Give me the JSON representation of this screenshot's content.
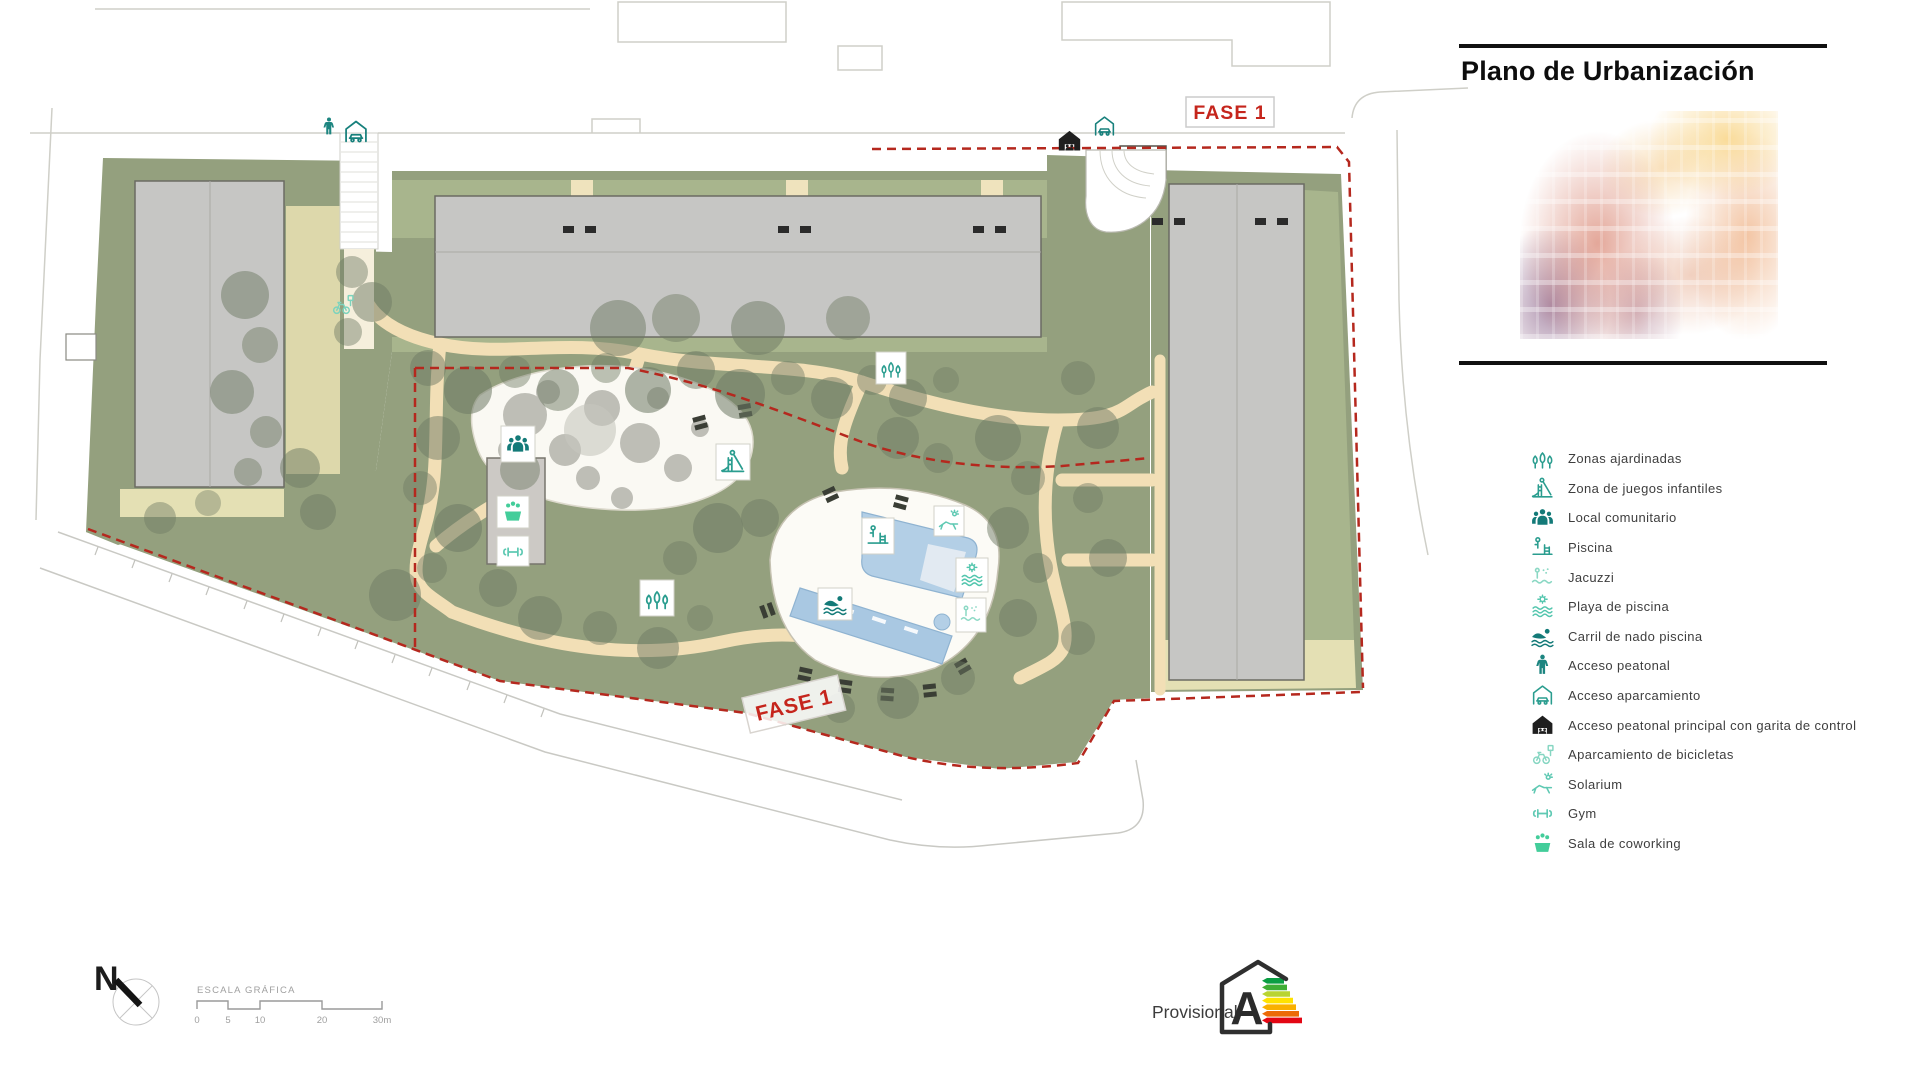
{
  "header": {
    "title": "Plano de Urbanización"
  },
  "plan": {
    "fase_label_top": "FASE 1",
    "fase_label_bottom": "FASE 1",
    "north_label": "N"
  },
  "scale_bar": {
    "title": "ESCALA GRÁFICA",
    "ticks": [
      "0",
      "5",
      "10",
      "20",
      "30m"
    ]
  },
  "energy": {
    "status": "Provisional",
    "rating": "A",
    "bar_colors": [
      "#0a9e43",
      "#3fae35",
      "#b9d432",
      "#ffe200",
      "#f9b000",
      "#ec6a08",
      "#e30613"
    ]
  },
  "legend": {
    "items": [
      {
        "icon": "trees-icon",
        "label": "Zonas ajardinadas",
        "color": "#2a9d8f"
      },
      {
        "icon": "playground-icon",
        "label": "Zona de juegos infantiles",
        "color": "#2a9d8f"
      },
      {
        "icon": "community-icon",
        "label": "Local comunitario",
        "color": "#137a78"
      },
      {
        "icon": "pool-icon",
        "label": "Piscina",
        "color": "#2a9d8f"
      },
      {
        "icon": "jacuzzi-icon",
        "label": "Jacuzzi",
        "color": "#8bd8c4"
      },
      {
        "icon": "pool-beach-icon",
        "label": "Playa de piscina",
        "color": "#54c6ae"
      },
      {
        "icon": "swim-lane-icon",
        "label": "Carril de nado piscina",
        "color": "#137a78"
      },
      {
        "icon": "pedestrian-access-icon",
        "label": "Acceso peatonal",
        "color": "#1d8580"
      },
      {
        "icon": "parking-access-icon",
        "label": "Acceso aparcamiento",
        "color": "#2a9d8f"
      },
      {
        "icon": "main-access-icon",
        "label": "Acceso peatonal principal con garita de control",
        "color": "#1f1f1f"
      },
      {
        "icon": "bike-parking-icon",
        "label": "Aparcamiento de bicicletas",
        "color": "#86d6c2"
      },
      {
        "icon": "solarium-icon",
        "label": "Solarium",
        "color": "#5fc9b3"
      },
      {
        "icon": "gym-icon",
        "label": "Gym",
        "color": "#5fc9b3"
      },
      {
        "icon": "coworking-icon",
        "label": "Sala de coworking",
        "color": "#43cd9a"
      }
    ]
  },
  "colors": {
    "accent_teal": "#2a9d8f",
    "phase_red": "#c5251c",
    "boundary_red": "#b5281e",
    "park_green": "#94a07e",
    "strip_green": "#a8b58d",
    "path_cream": "#f2dfb6",
    "building_gray": "#c6c6c4",
    "pool_blue": "#aecbe4"
  }
}
